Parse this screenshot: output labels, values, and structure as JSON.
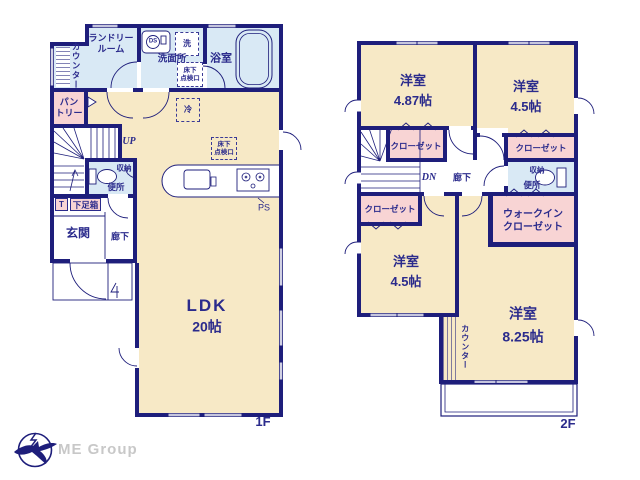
{
  "colors": {
    "wall": "#1e1e7b",
    "text": "#2b2b8c",
    "room_beige": "#f7e9c6",
    "room_blue": "#d9e9f5",
    "room_pink": "#f8d4d4",
    "logo_gray": "#c8c8c8"
  },
  "floor1": {
    "floor_label": "1F",
    "laundry": "ランドリールーム",
    "counter": "カウンター",
    "washroom": "洗面所",
    "washer": "洗",
    "ds": "DS",
    "bathroom": "浴室",
    "hatch_line1": "床下",
    "hatch_line2": "点検口",
    "pantry_line1": "パン",
    "pantry_line2": "トリー",
    "fridge": "冷",
    "up": "UP",
    "storage": "収納",
    "toilet": "便所",
    "t_box": "T",
    "shoebox": "下足箱",
    "entrance": "玄関",
    "corridor": "廊下",
    "ps": "PS",
    "ldk": "LDK",
    "ldk_size": "20帖"
  },
  "floor2": {
    "floor_label": "2F",
    "bed1": "洋室",
    "bed1_size": "4.87帖",
    "bed2": "洋室",
    "bed2_size": "4.5帖",
    "bed3": "洋室",
    "bed3_size": "4.5帖",
    "bed4": "洋室",
    "bed4_size": "8.25帖",
    "closet": "クローゼット",
    "wic_line1": "ウォークイン",
    "wic_line2": "クローゼット",
    "dn": "DN",
    "corridor": "廊下",
    "storage": "収納",
    "toilet": "便所",
    "counter": "カウンター"
  },
  "logo": {
    "text": "ME Group"
  }
}
